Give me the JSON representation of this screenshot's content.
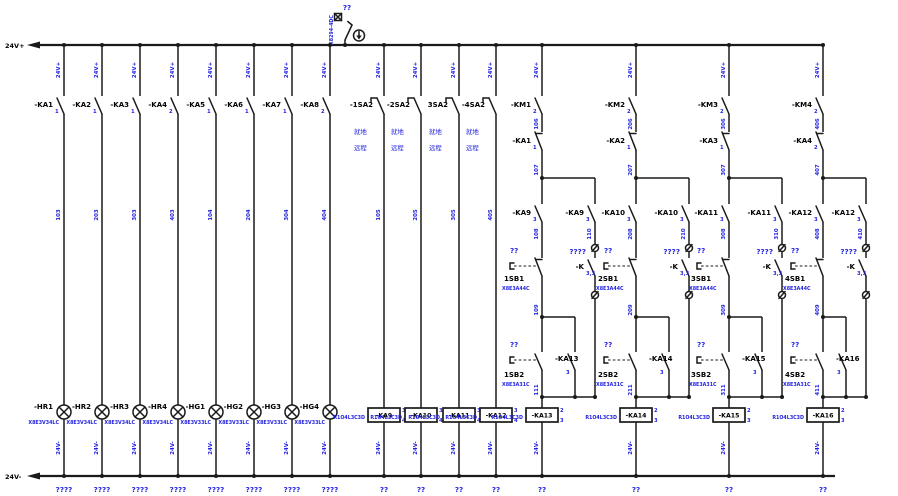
{
  "rails": {
    "positive": "24V+",
    "negative": "24V-"
  },
  "top_device": {
    "label": "??",
    "ref": "X8294-4DC"
  },
  "lamp_columns": [
    {
      "wire_top": "24V+",
      "contact": "-KA1",
      "pin": "1",
      "wire_mid": "103",
      "lamp": "-HR1",
      "lamp_ref": "X8E3V34LC",
      "wire_bot": "24V-",
      "terminal": "????"
    },
    {
      "wire_top": "24V+",
      "contact": "-KA2",
      "pin": "1",
      "wire_mid": "203",
      "lamp": "-HR2",
      "lamp_ref": "X8E3V34LC",
      "wire_bot": "24V-",
      "terminal": "????"
    },
    {
      "wire_top": "24V+",
      "contact": "-KA3",
      "pin": "1",
      "wire_mid": "303",
      "lamp": "-HR3",
      "lamp_ref": "X8E3V34LC",
      "wire_bot": "24V-",
      "terminal": "????"
    },
    {
      "wire_top": "24V+",
      "contact": "-KA4",
      "pin": "2",
      "wire_mid": "403",
      "lamp": "-HR4",
      "lamp_ref": "X8E3V34LC",
      "wire_bot": "24V-",
      "terminal": "????"
    },
    {
      "wire_top": "24V+",
      "contact": "-KA5",
      "pin": "1",
      "wire_mid": "104",
      "lamp": "-HG1",
      "lamp_ref": "X8E3V33LC",
      "wire_bot": "24V-",
      "terminal": "????"
    },
    {
      "wire_top": "24V+",
      "contact": "-KA6",
      "pin": "1",
      "wire_mid": "204",
      "lamp": "-HG2",
      "lamp_ref": "X8E3V33LC",
      "wire_bot": "24V-",
      "terminal": "????"
    },
    {
      "wire_top": "24V+",
      "contact": "-KA7",
      "pin": "1",
      "wire_mid": "304",
      "lamp": "-HG3",
      "lamp_ref": "X8E3V33LC",
      "wire_bot": "24V-",
      "terminal": "????"
    },
    {
      "wire_top": "24V+",
      "contact": "-KA8",
      "pin": "2",
      "wire_mid": "404",
      "lamp": "-HG4",
      "lamp_ref": "X8E3V33LC",
      "wire_bot": "24V-",
      "terminal": "????"
    }
  ],
  "selector_columns": [
    {
      "wire_top": "24V+",
      "switch": "-1SA2",
      "local": "就地",
      "remote": "远程",
      "wire_mid": "105",
      "coil": "-KA9",
      "coil_ref": "R1O4L3C3D",
      "coil_pin_top": "3",
      "coil_pin_bot": "4",
      "wire_bot": "24V-",
      "terminal": "??"
    },
    {
      "wire_top": "24V+",
      "switch": "-2SA2",
      "local": "就地",
      "remote": "远程",
      "wire_mid": "205",
      "coil": "-KA10",
      "coil_ref": "R1O4L3C3D",
      "coil_pin_top": "3",
      "coil_pin_bot": "4",
      "wire_bot": "24V-",
      "terminal": "??"
    },
    {
      "wire_top": "24V+",
      "switch": "3SA2",
      "local": "就地",
      "remote": "远程",
      "wire_mid": "305",
      "coil": "-KA11",
      "coil_ref": "R1O4L3C3D",
      "coil_pin_top": "3",
      "coil_pin_bot": "4",
      "wire_bot": "24V-",
      "terminal": "??"
    },
    {
      "wire_top": "24V+",
      "switch": "-4SA2",
      "local": "就地",
      "remote": "远程",
      "wire_mid": "405",
      "coil": "-KA12",
      "coil_ref": "R1O4L3C3D",
      "coil_pin_top": "3",
      "coil_pin_bot": "4",
      "wire_bot": "24V-",
      "terminal": "??"
    }
  ],
  "starter_columns": [
    {
      "wire_top": "24V+",
      "km": "-KM1",
      "km_pin": "2",
      "wire_km": "106",
      "ka": "-KA1",
      "ka_pin": "1",
      "wire_node": "107",
      "main_contact": "-KA9",
      "main_pin": "3",
      "wire_main": "108",
      "sb1_q": "??",
      "sb1": "1SB1",
      "sb1_ref": "X8E3A44C",
      "wire_node2": "109",
      "sb2_q": "??",
      "sb2": "1SB2",
      "sb2_ref": "X8E3A31C",
      "seal_contact": "-KA13",
      "seal_pin": "3",
      "remote_contact": "-KA9",
      "remote_pin": "3",
      "wire_remote": "110",
      "remote_q": "????",
      "k": "-K",
      "k_pin": "3,3",
      "wire_join": "111",
      "coil": "-KA13",
      "coil_ref": "R1O4L3C3D",
      "coil_pin_top": "2",
      "coil_pin_bot": "3",
      "wire_bot": "24V-",
      "terminal": "??"
    },
    {
      "wire_top": "24V+",
      "km": "-KM2",
      "km_pin": "2",
      "wire_km": "206",
      "ka": "-KA2",
      "ka_pin": "1",
      "wire_node": "207",
      "main_contact": "-KA10",
      "main_pin": "3",
      "wire_main": "208",
      "sb1_q": "??",
      "sb1": "2SB1",
      "sb1_ref": "X8E3A44C",
      "wire_node2": "209",
      "sb2_q": "??",
      "sb2": "2SB2",
      "sb2_ref": "X8E3A31C",
      "seal_contact": "-KA14",
      "seal_pin": "3",
      "remote_contact": "-KA10",
      "remote_pin": "3",
      "wire_remote": "210",
      "remote_q": "????",
      "k": "-K",
      "k_pin": "3,3",
      "wire_join": "211",
      "coil": "-KA14",
      "coil_ref": "R1O4L3C3D",
      "coil_pin_top": "2",
      "coil_pin_bot": "3",
      "wire_bot": "24V-",
      "terminal": "??"
    },
    {
      "wire_top": "24V+",
      "km": "-KM3",
      "km_pin": "2",
      "wire_km": "306",
      "ka": "-KA3",
      "ka_pin": "1",
      "wire_node": "307",
      "main_contact": "-KA11",
      "main_pin": "3",
      "wire_main": "308",
      "sb1_q": "??",
      "sb1": "3SB1",
      "sb1_ref": "X8E3A44C",
      "wire_node2": "309",
      "sb2_q": "??",
      "sb2": "3SB2",
      "sb2_ref": "X8E3A31C",
      "seal_contact": "-KA15",
      "seal_pin": "3",
      "remote_contact": "-KA11",
      "remote_pin": "3",
      "wire_remote": "310",
      "remote_q": "????",
      "k": "-K",
      "k_pin": "3,3",
      "wire_join": "311",
      "coil": "-KA15",
      "coil_ref": "R1O4L3C3D",
      "coil_pin_top": "2",
      "coil_pin_bot": "3",
      "wire_bot": "24V-",
      "terminal": "??"
    },
    {
      "wire_top": "24V+",
      "km": "-KM4",
      "km_pin": "2",
      "wire_km": "406",
      "ka": "-KA4",
      "ka_pin": "2",
      "wire_node": "407",
      "main_contact": "-KA12",
      "main_pin": "3",
      "wire_main": "408",
      "sb1_q": "??",
      "sb1": "4SB1",
      "sb1_ref": "X8E3A44C",
      "wire_node2": "409",
      "sb2_q": "??",
      "sb2": "4SB2",
      "sb2_ref": "X8E3A31C",
      "seal_contact": "-KA16",
      "seal_pin": "3",
      "remote_contact": "-KA12",
      "remote_pin": "3",
      "wire_remote": "410",
      "remote_q": "????",
      "k": "-K",
      "k_pin": "3,3",
      "wire_join": "411",
      "coil": "-KA16",
      "coil_ref": "R1O4L3C3D",
      "coil_pin_top": "2",
      "coil_pin_bot": "3",
      "wire_bot": "24V-",
      "terminal": "??"
    }
  ]
}
